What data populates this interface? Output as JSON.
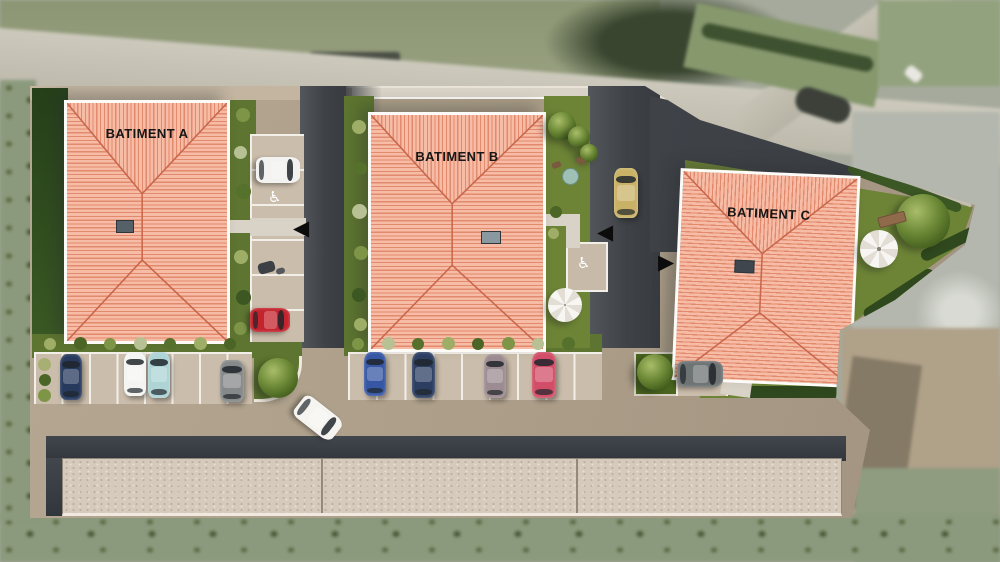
{
  "plan": {
    "type": "residential-site-plan-aerial-render",
    "buildings": [
      {
        "id": "A",
        "label": "BATIMENT A"
      },
      {
        "id": "B",
        "label": "BATIMENT B"
      },
      {
        "id": "C",
        "label": "BATIMENT C"
      }
    ],
    "markers": {
      "handicap_symbol": "♿",
      "arrow_left": "◀",
      "arrow_right": "▶"
    },
    "parking": {
      "rows": [
        {
          "name": "west-row",
          "stalls": 8,
          "parked_cars": [
            "navy",
            "white",
            "teal",
            "gray"
          ]
        },
        {
          "name": "center-row",
          "stalls": 9,
          "parked_cars": [
            "blue",
            "dark-blue",
            "mauve",
            "pink"
          ]
        },
        {
          "name": "building-a-side-row",
          "stalls": 5,
          "parked_cars": [
            "white",
            "red"
          ],
          "features": [
            "handicap-stall",
            "scooter"
          ]
        },
        {
          "name": "building-c-stall",
          "stalls": 1,
          "parked_cars": [
            "dark-gray"
          ]
        },
        {
          "name": "building-b-garden-handicap-stall",
          "stalls": 1,
          "parked_cars": []
        }
      ],
      "moving_cars": [
        "white-on-main-drive",
        "gold-on-north-drive"
      ]
    },
    "amenities": [
      "parasol-near-b",
      "parasol-in-c-garden",
      "garden-table-with-chairs",
      "bench",
      "trees",
      "hedges",
      "garage-block-3-sections"
    ]
  },
  "colors": {
    "roof_tile": "#f6bca6",
    "roof_stripe": "#e28a6e",
    "roof_ridge": "#c9674c",
    "paving": "#ab9d87",
    "stall": "#cbbdab",
    "stall_line": "#f2efe8",
    "asphalt": "#42464b",
    "grass": "#6d8436",
    "hedge": "#2f481d",
    "garage_roof": "#d5cabb",
    "label_text": "#161616"
  }
}
